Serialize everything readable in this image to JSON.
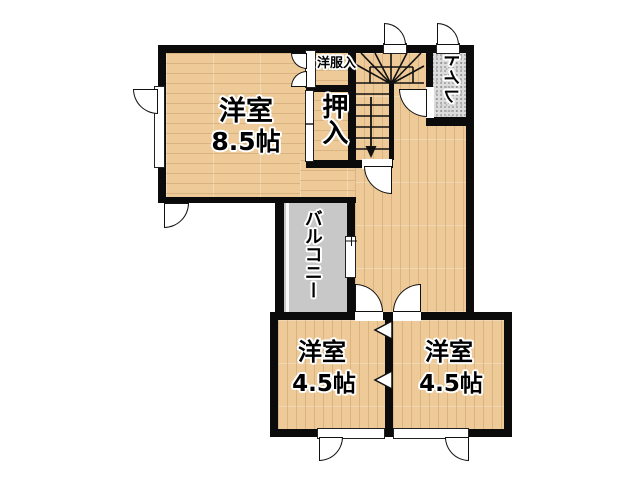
{
  "floor_plan": {
    "rooms": {
      "western_room_85": {
        "name": "洋室",
        "size": "8.5帖"
      },
      "closet_oshiire": {
        "name": "押入"
      },
      "clothes_closet": {
        "name": "洋服入"
      },
      "toilet": {
        "name": "トイレ"
      },
      "balcony": {
        "name": "バルコニー"
      },
      "western_room_45_left": {
        "name": "洋室",
        "size": "4.5帖"
      },
      "western_room_45_right": {
        "name": "洋室",
        "size": "4.5帖"
      }
    },
    "colors": {
      "wood_floor": "#edca97",
      "wall": "#0b0b0b",
      "balcony_floor": "#c8c8c8",
      "toilet_floor": "#dcdcdc",
      "text_halo": "#ffffff"
    }
  }
}
